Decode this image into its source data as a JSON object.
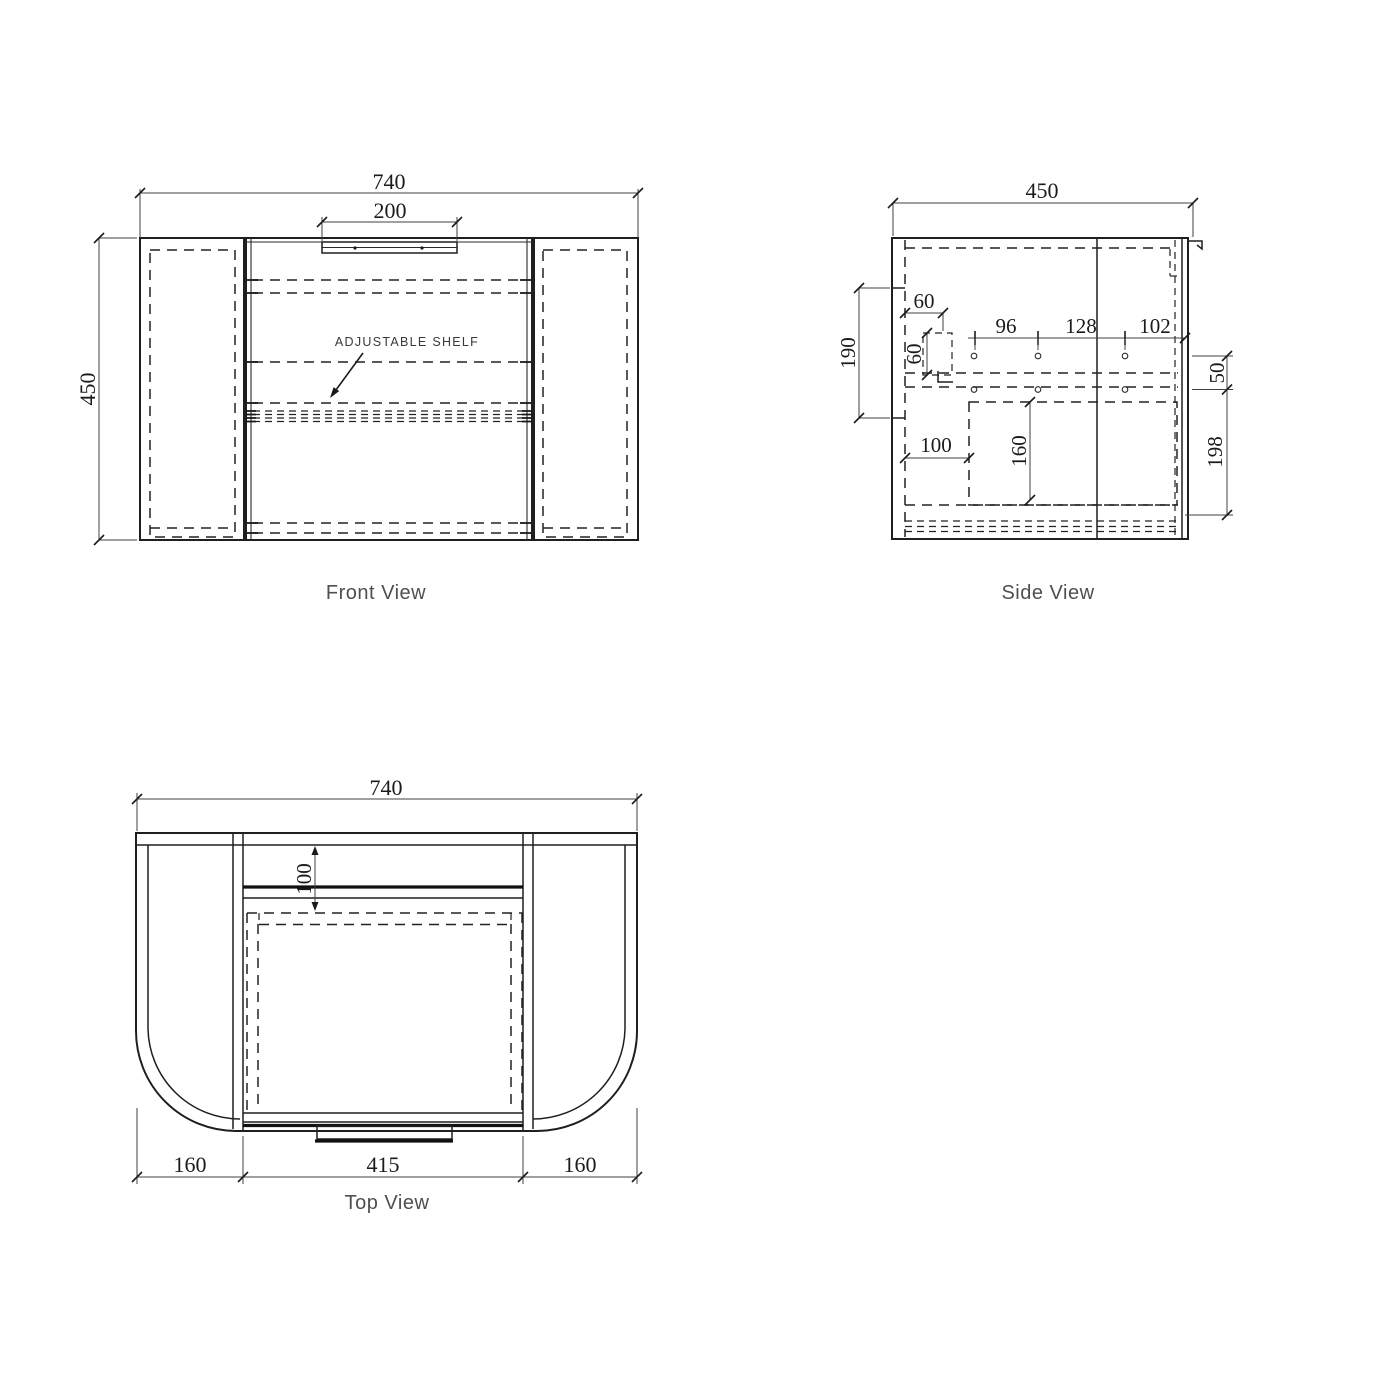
{
  "front": {
    "label": "Front View",
    "dim_width": "740",
    "dim_handle": "200",
    "dim_height": "450",
    "callout": "ADJUSTABLE SHELF"
  },
  "side": {
    "label": "Side View",
    "dim_depth": "450",
    "dim_wall_span": "190",
    "dim_bracket_offset": "60",
    "dim_bracket_size": "60",
    "dim_hole_pitch_a": "96",
    "dim_hole_pitch_b": "128",
    "dim_hole_pitch_c": "102",
    "dim_hole_row_gap": "50",
    "dim_bottom_offset": "198",
    "dim_cutout_offset": "100",
    "dim_cutout_depth": "160"
  },
  "top": {
    "label": "Top View",
    "dim_width": "740",
    "dim_back_inset": "100",
    "dim_left": "160",
    "dim_center": "415",
    "dim_right": "160"
  }
}
